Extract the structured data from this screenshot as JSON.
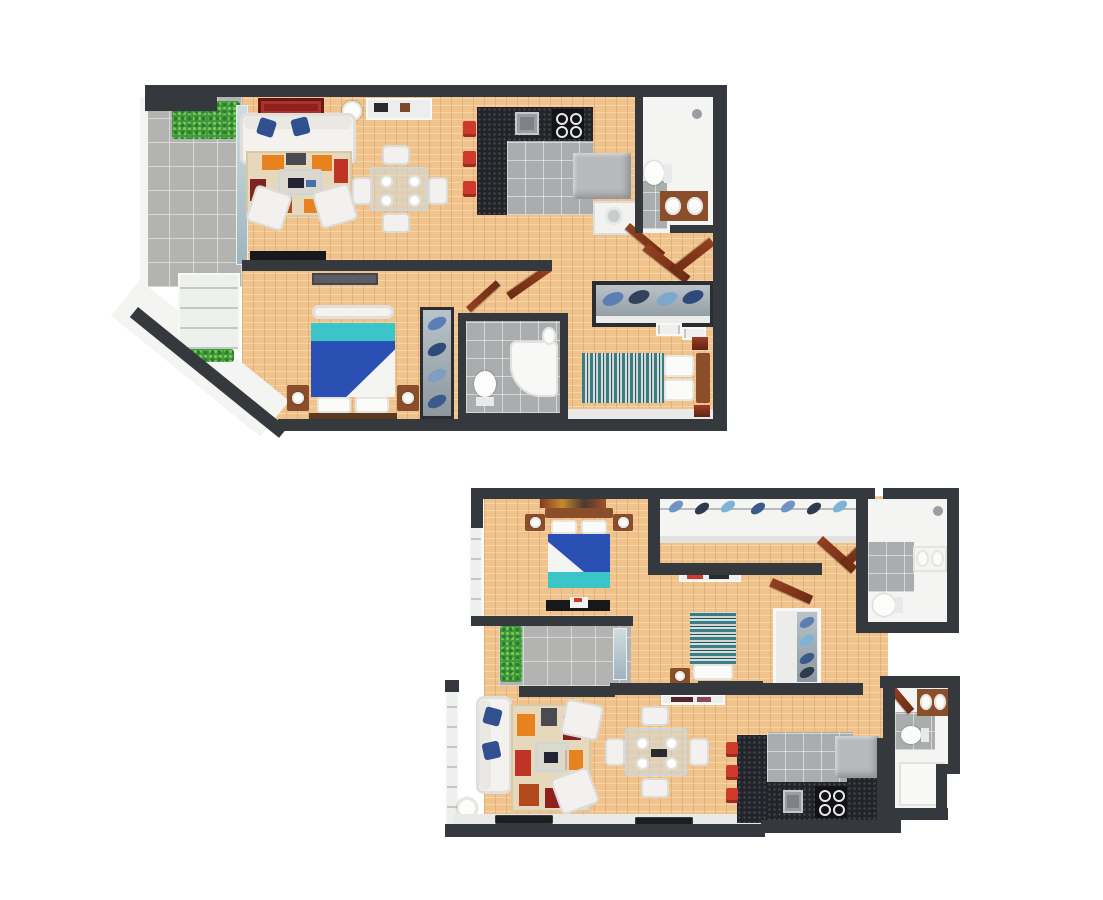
{
  "title": "3D rendered two-level apartment floor plan",
  "colors": {
    "wall": "#35383d",
    "wood_floor": "#f0c38c",
    "tile": "#a9adad",
    "white_surface": "#f4f4f2",
    "ledge": "#e9e9e7",
    "granite": "#22242a",
    "teal": "#3cc5c8",
    "duvet_blue": "#2a50b4",
    "pillow_navy": "#31508f",
    "rug_red": "#8e211d",
    "orange": "#e8821f",
    "accent_red": "#d03a2c",
    "door_brown": "#93401f",
    "door_brown_dark": "#6e2c13",
    "plant_green": "#3f9b40",
    "stripe_teal": "#3a7d85",
    "furniture_wood": "#8a4f2a",
    "art_red": "#a03b28",
    "appliance_gray": "#b7babc",
    "metal_gray": "#9a9ea2",
    "glass_blue": "#b9c9cf"
  },
  "plans": [
    {
      "name": "upper-floor-plan",
      "position": "top-left of image",
      "rooms": [
        "balcony-with-plant",
        "living-dining-room",
        "kitchen",
        "bathroom-ensuite",
        "entry-hall",
        "master-bedroom",
        "master-balcony",
        "second-bathroom",
        "second-bedroom",
        "hallway-with-wardrobes"
      ],
      "furniture": [
        "sofa-with-blue-pillows",
        "patchwork-rug",
        "coffee-table",
        "two-armchairs",
        "red-patterned-rug",
        "console-shelf",
        "floor-lamp",
        "glass-dining-table-four-chairs",
        "tv-unit",
        "granite-kitchen-counter",
        "sink",
        "cooktop",
        "fridge",
        "washing-machine",
        "three-red-bar-stools",
        "double-bed-blue-teal",
        "two-nightstands-with-lamps",
        "wall-tv",
        "glass-wardrobe-with-clothes",
        "shoe-cabinet-with-clothes",
        "corner-shower",
        "toilet",
        "double-basin-vanity",
        "single-bed-striped",
        "wall-art"
      ]
    },
    {
      "name": "lower-floor-plan",
      "position": "bottom-right of image",
      "rooms": [
        "bedroom-one",
        "walk-in-closet",
        "bathroom-ensuite",
        "bedroom-two",
        "balcony-with-plant",
        "living-dining-room",
        "kitchen",
        "second-bathroom",
        "hallway"
      ],
      "furniture": [
        "double-bed-blue-teal",
        "headboard-artwork",
        "two-nightstands-with-lamps",
        "foot-bench",
        "hanging-clothes-rail",
        "single-bed-striped",
        "dresser",
        "wardrobe-with-clothes",
        "sofa-with-blue-pillows",
        "patchwork-rug",
        "coffee-table",
        "two-armchairs",
        "floor-lamp",
        "glass-dining-table-four-chairs",
        "granite-kitchen-counter",
        "sink",
        "cooktop",
        "fridge",
        "three-red-bar-stools",
        "double-basin-vanity",
        "toilet",
        "shower",
        "entry-mats"
      ]
    }
  ]
}
